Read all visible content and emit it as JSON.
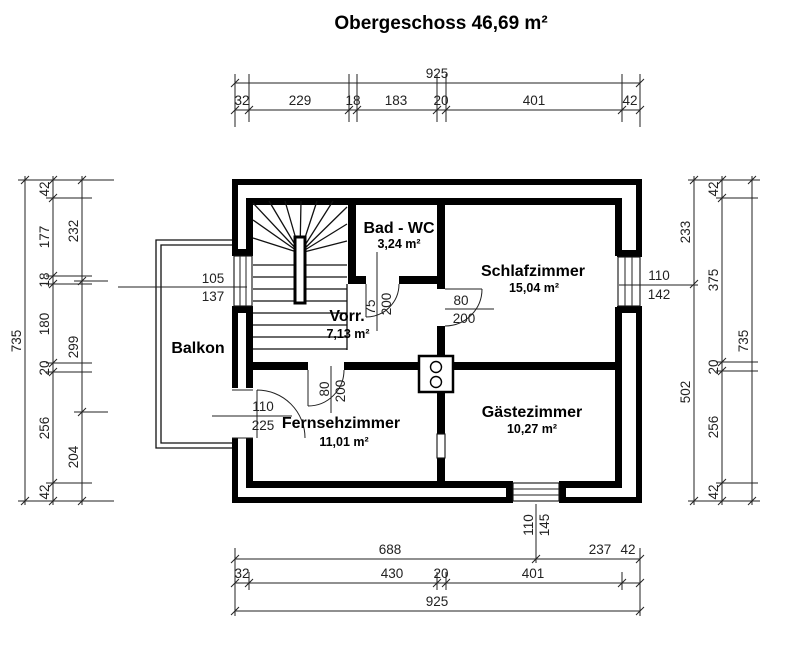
{
  "title": "Obergeschoss 46,69 m²",
  "rooms": {
    "bad_wc": {
      "name": "Bad - WC",
      "area": "3,24 m²"
    },
    "schlafzimmer": {
      "name": "Schlafzimmer",
      "area": "15,04 m²"
    },
    "vorraum": {
      "name": "Vorr.",
      "area": "7,13 m²"
    },
    "fernsehzimmer": {
      "name": "Fernsehzimmer",
      "area": "11,01 m²"
    },
    "gaestezimmer": {
      "name": "Gästezimmer",
      "area": "10,27 m²"
    },
    "balkon": {
      "name": "Balkon"
    }
  },
  "openings": {
    "stair_window": {
      "w": "105",
      "h": "137"
    },
    "schlaf_window": {
      "w": "110",
      "h": "142"
    },
    "gaeste_window": {
      "w": "110",
      "h": "145"
    },
    "balkon_door": {
      "w": "110",
      "h": "225"
    },
    "bad_door": {
      "w": "75",
      "h": "200"
    },
    "schlaf_door": {
      "w": "80",
      "h": "200"
    },
    "fernseh_door": {
      "w": "80",
      "h": "200"
    }
  },
  "dims": {
    "top": {
      "total": "925",
      "segs": [
        "32",
        "229",
        "18",
        "183",
        "20",
        "401",
        "42"
      ]
    },
    "bottom": {
      "row1": [
        "688",
        "237",
        "42"
      ],
      "row2": [
        "32",
        "430",
        "20",
        "401"
      ],
      "total": "925"
    },
    "left": {
      "total": "735",
      "wall": [
        "42",
        "177",
        "18",
        "180",
        "20",
        "256",
        "42"
      ],
      "inner": [
        "232",
        "299",
        "204"
      ]
    },
    "right": {
      "total": "735",
      "wall": [
        "42",
        "375",
        "20",
        "256",
        "42"
      ],
      "inner": [
        "233",
        "502"
      ]
    }
  }
}
